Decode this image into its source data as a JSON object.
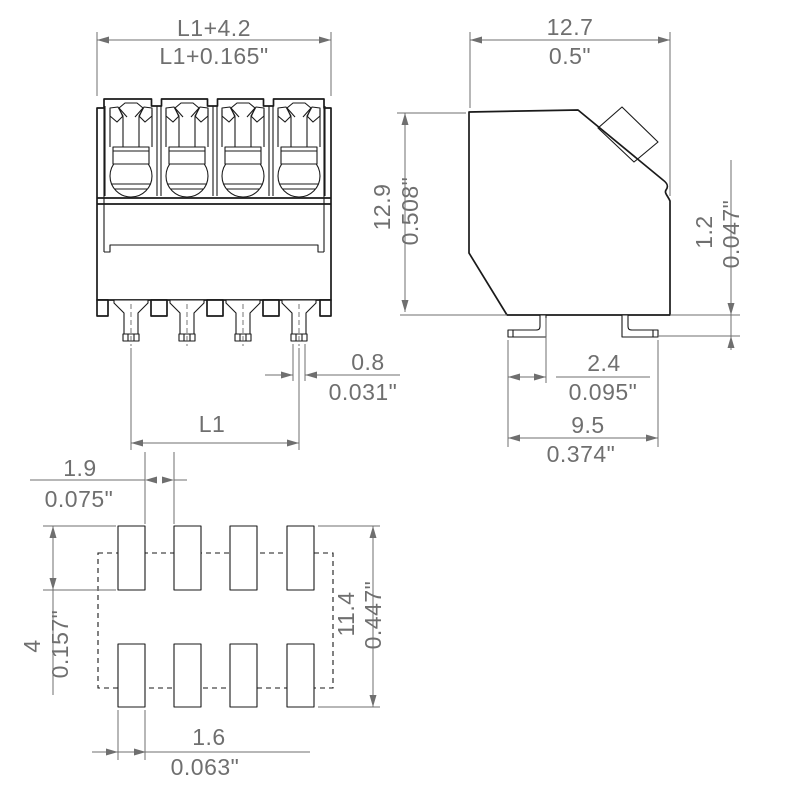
{
  "drawing": {
    "type": "technical-dimension-drawing",
    "component": "4-pole SMD terminal block: front view, side view, solder pad footprint",
    "colors": {
      "background": "#ffffff",
      "outline": "#1a1a1a",
      "dimension": "#6f6f6f"
    }
  },
  "dims": {
    "front_width": {
      "mm": "L1+4.2",
      "in": "L1+0.165\""
    },
    "side_width": {
      "mm": "12.7",
      "in": "0.5\""
    },
    "side_height": {
      "mm": "12.9",
      "in": "0.508\""
    },
    "foot_height": {
      "mm": "1.2",
      "in": "0.047\""
    },
    "pin_width": {
      "mm": "0.8",
      "in": "0.031\""
    },
    "pin_span": {
      "label": "L1"
    },
    "foot_inset": {
      "mm": "2.4",
      "in": "0.095\""
    },
    "foot_span": {
      "mm": "9.5",
      "in": "0.374\""
    },
    "pad_gap": {
      "mm": "1.9",
      "in": "0.075\""
    },
    "pad_height": {
      "mm": "4",
      "in": "0.157\""
    },
    "pad_rows_span": {
      "mm": "11.4",
      "in": "0.447\""
    },
    "pad_width": {
      "mm": "1.6",
      "in": "0.063\""
    }
  }
}
